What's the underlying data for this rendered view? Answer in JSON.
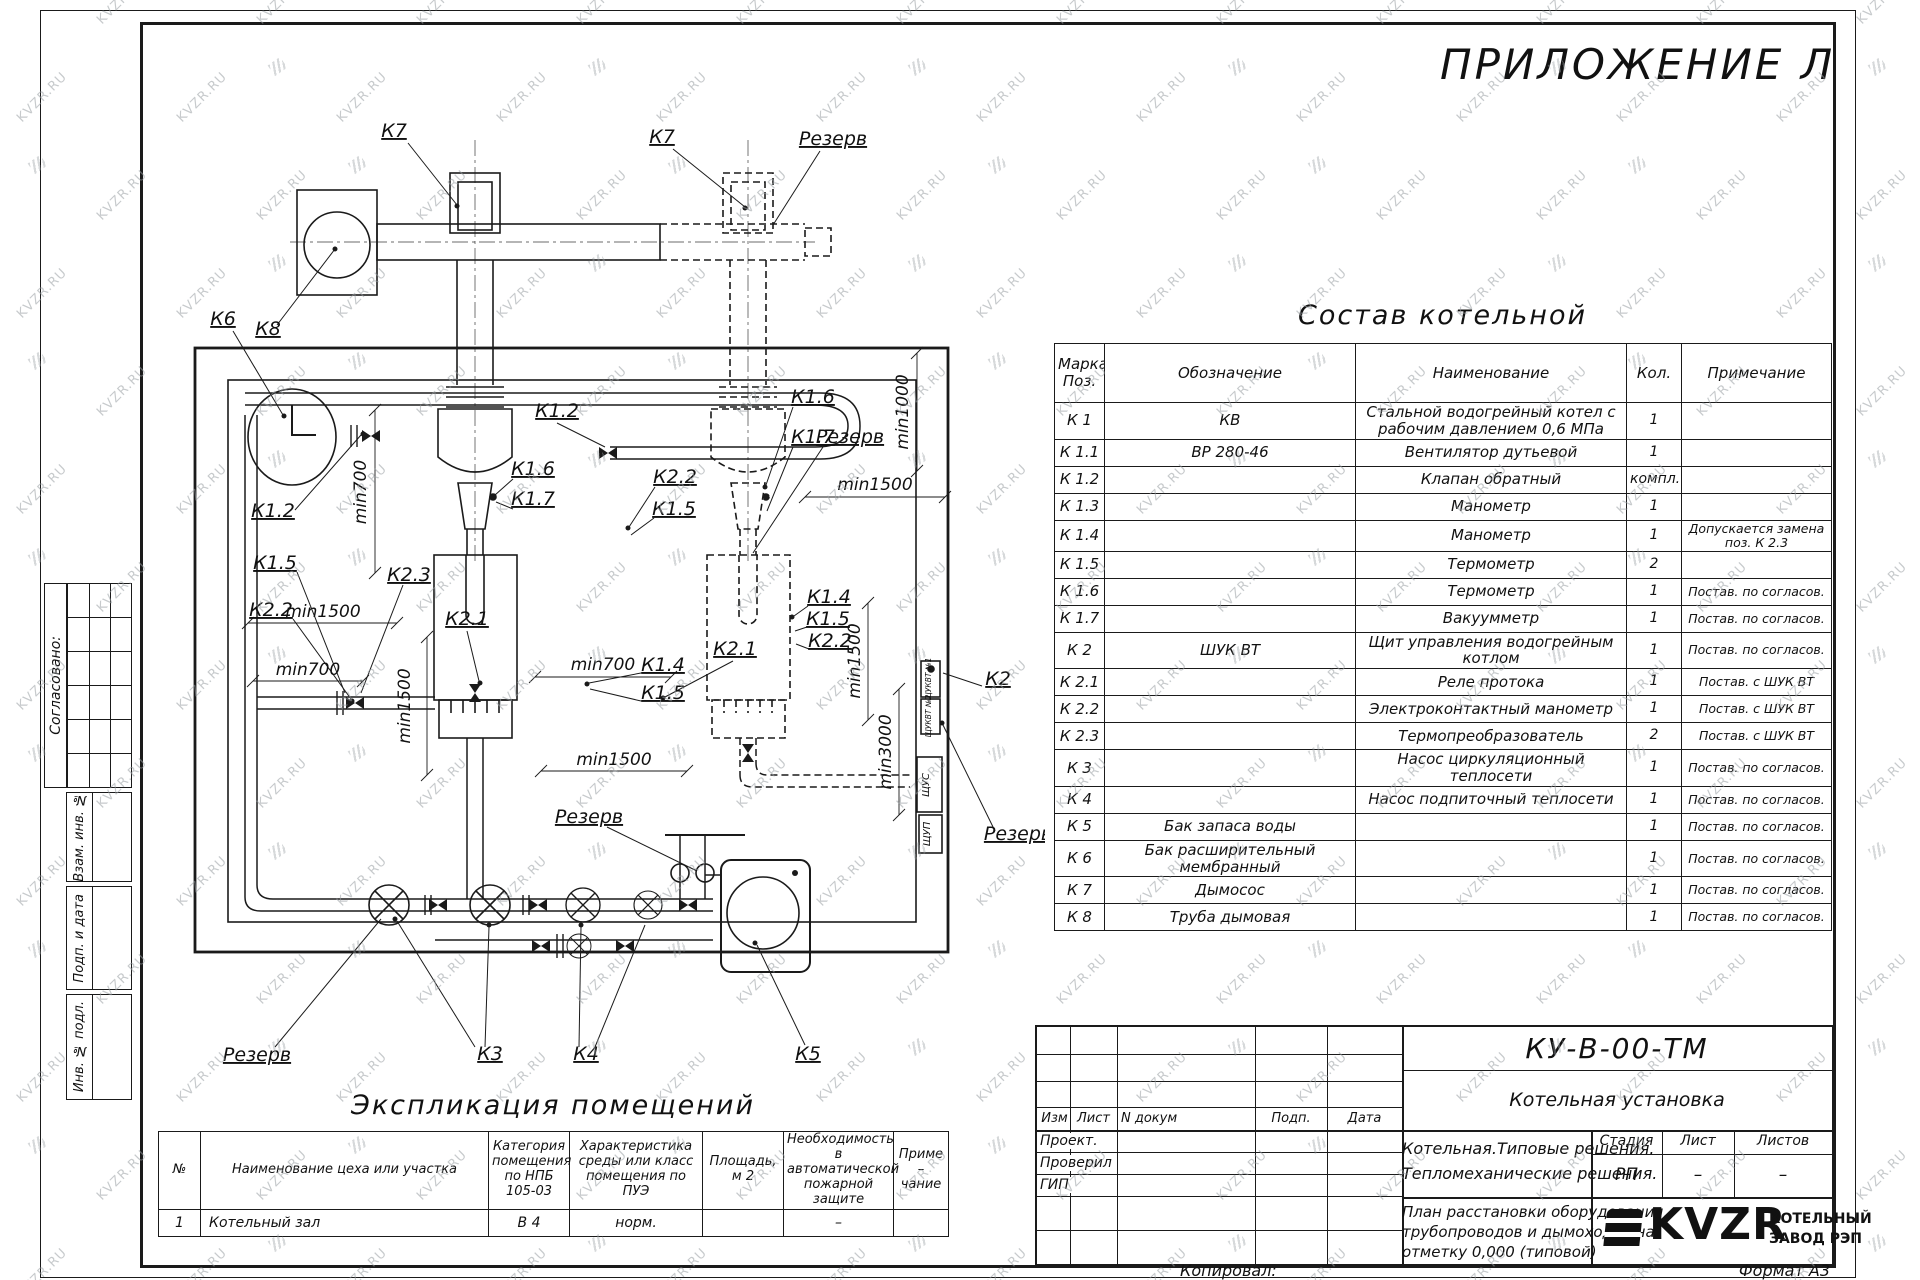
{
  "watermark": {
    "text": "KVZR.RU"
  },
  "page": {
    "appendix": "ПРИЛОЖЕНИЕ Л",
    "copied": "Копировал:",
    "format": "Формат А3"
  },
  "sidebar": {
    "agreed": "Согласовано:",
    "stamps": [
      "Взам. инв. №",
      "Подп. и дата",
      "Инв. № подл."
    ]
  },
  "composition": {
    "title": "Состав котельной",
    "headers": [
      "Марка Поз.",
      "Обозначение",
      "Наименование",
      "Кол.",
      "Примечание"
    ],
    "rows": [
      {
        "pos": "К 1",
        "sign": "КВ",
        "name": "Стальной водогрейный котел с рабочим давлением  0,6  МПа",
        "qty": "1",
        "note": ""
      },
      {
        "pos": "К 1.1",
        "sign": "ВР 280-46",
        "name": "Вентилятор дутьевой",
        "qty": "1",
        "note": ""
      },
      {
        "pos": "К 1.2",
        "sign": "",
        "name": "Клапан обратный",
        "qty": "компл.",
        "note": ""
      },
      {
        "pos": "К 1.3",
        "sign": "",
        "name": "Манометр",
        "qty": "1",
        "note": ""
      },
      {
        "pos": "К 1.4",
        "sign": "",
        "name": "Манометр",
        "qty": "1",
        "note": "Допускается замена поз. К 2.3"
      },
      {
        "pos": "К 1.5",
        "sign": "",
        "name": "Термометр",
        "qty": "2",
        "note": ""
      },
      {
        "pos": "К 1.6",
        "sign": "",
        "name": "Термометр",
        "qty": "1",
        "note": "Постав. по согласов."
      },
      {
        "pos": "К 1.7",
        "sign": "",
        "name": "Вакуумметр",
        "qty": "1",
        "note": "Постав. по согласов."
      },
      {
        "pos": "К 2",
        "sign": "ШУК ВТ",
        "name": "Щит управления водогрейным котлом",
        "qty": "1",
        "note": "Постав. по согласов."
      },
      {
        "pos": "К 2.1",
        "sign": "",
        "name": "Реле протока",
        "qty": "1",
        "note": "Постав. с ШУК ВТ"
      },
      {
        "pos": "К 2.2",
        "sign": "",
        "name": "Электроконтактный манометр",
        "qty": "1",
        "note": "Постав. с ШУК ВТ"
      },
      {
        "pos": "К 2.3",
        "sign": "",
        "name": "Термопреобразователь",
        "qty": "2",
        "note": "Постав. с ШУК ВТ"
      },
      {
        "pos": "К 3",
        "sign": "",
        "name": "Насос циркуляционный теплосети",
        "qty": "1",
        "note": "Постав. по согласов."
      },
      {
        "pos": "К 4",
        "sign": "",
        "name": "Насос подпиточный теплосети",
        "qty": "1",
        "note": "Постав. по согласов."
      },
      {
        "pos": "К 5",
        "sign": "Бак запаса воды",
        "name": "",
        "qty": "1",
        "note": "Постав. по согласов."
      },
      {
        "pos": "К 6",
        "sign": "Бак расширительный мембранный",
        "name": "",
        "qty": "1",
        "note": "Постав. по согласов."
      },
      {
        "pos": "К 7",
        "sign": "Дымосос",
        "name": "",
        "qty": "1",
        "note": "Постав. по согласов."
      },
      {
        "pos": "К 8",
        "sign": "Труба дымовая",
        "name": "",
        "qty": "1",
        "note": "Постав. по согласов."
      }
    ]
  },
  "explication": {
    "title": "Экспликация помещений",
    "headers": [
      "№",
      "Наименование цеха или участка",
      "Категория помещения по НПБ 105-03",
      "Характеристика среды или класс помещения по ПУЭ",
      "Площадь, м 2",
      "Необходимость в автоматической пожарной защите",
      "Приме – чание"
    ],
    "rows": [
      [
        "1",
        "Котельный зал",
        "В 4",
        "норм.",
        "",
        "–",
        ""
      ]
    ]
  },
  "titleblock": {
    "doc": "КУ-В-00-ТМ",
    "object": "Котельная установка",
    "cols": [
      "Изм",
      "Лист",
      "N докум",
      "Подп.",
      "Дата"
    ],
    "roles": [
      "Проект.",
      "Проверил",
      "ГИП"
    ],
    "desc1": "Котельная.Типовые решения.",
    "desc2": "Тепломеханические решения.",
    "stage_h": [
      "Стадия",
      "Лист",
      "Листов"
    ],
    "stage_v": [
      "РП",
      "–",
      "–"
    ],
    "sheet1": "План расстановки оборудования,",
    "sheet2": "трубопроводов и дымоходов на",
    "sheet3": "отметку  0,000  (типовой)",
    "brand": "KVZR",
    "brand_line1": "КОТЕЛЬНЫЙ",
    "brand_line2": "ЗАВОД РЭП"
  },
  "plan": {
    "labels": [
      {
        "t": "К7",
        "x": 289,
        "y": 52,
        "s": "k"
      },
      {
        "t": "К7",
        "x": 557,
        "y": 58,
        "s": "k"
      },
      {
        "t": "Резерв",
        "x": 728,
        "y": 60,
        "s": "r"
      },
      {
        "t": "К8",
        "x": 163,
        "y": 250,
        "s": "k"
      },
      {
        "t": "К6",
        "x": 118,
        "y": 240,
        "s": "k"
      },
      {
        "t": "К1.2",
        "x": 452,
        "y": 332,
        "s": "k"
      },
      {
        "t": "К1.6",
        "x": 428,
        "y": 390,
        "s": "k"
      },
      {
        "t": "К1.7",
        "x": 428,
        "y": 420,
        "s": "k"
      },
      {
        "t": "К1.6",
        "x": 708,
        "y": 318,
        "s": "k"
      },
      {
        "t": "К1.7",
        "x": 708,
        "y": 358,
        "s": "k"
      },
      {
        "t": "К2.2",
        "x": 570,
        "y": 398,
        "s": "k"
      },
      {
        "t": "К1.5",
        "x": 569,
        "y": 430,
        "s": "k"
      },
      {
        "t": "Резерв",
        "x": 745,
        "y": 358,
        "s": "r"
      },
      {
        "t": "min1000",
        "x": 803,
        "y": 327,
        "s": "d",
        "r": -90
      },
      {
        "t": "min1500",
        "x": 770,
        "y": 405,
        "s": "d"
      },
      {
        "t": "К1.2",
        "x": 168,
        "y": 432,
        "s": "k"
      },
      {
        "t": "К1.5",
        "x": 170,
        "y": 484,
        "s": "k"
      },
      {
        "t": "К2.2",
        "x": 166,
        "y": 531,
        "s": "k"
      },
      {
        "t": "К2.3",
        "x": 304,
        "y": 496,
        "s": "k"
      },
      {
        "t": "min700",
        "x": 261,
        "y": 407,
        "s": "d",
        "r": -90
      },
      {
        "t": "min700",
        "x": 203,
        "y": 590,
        "s": "d"
      },
      {
        "t": "min1500",
        "x": 218,
        "y": 532,
        "s": "d"
      },
      {
        "t": "К1.4",
        "x": 558,
        "y": 586,
        "s": "k"
      },
      {
        "t": "К1.5",
        "x": 558,
        "y": 614,
        "s": "k"
      },
      {
        "t": "К2.1",
        "x": 362,
        "y": 540,
        "s": "k"
      },
      {
        "t": "min1500",
        "x": 305,
        "y": 621,
        "s": "d",
        "r": -90
      },
      {
        "t": "min700",
        "x": 498,
        "y": 585,
        "s": "d"
      },
      {
        "t": "min1500",
        "x": 509,
        "y": 680,
        "s": "d"
      },
      {
        "t": "К2.1",
        "x": 630,
        "y": 570,
        "s": "k"
      },
      {
        "t": "К1.4",
        "x": 724,
        "y": 518,
        "s": "k"
      },
      {
        "t": "К1.5",
        "x": 723,
        "y": 540,
        "s": "k"
      },
      {
        "t": "К2.2",
        "x": 725,
        "y": 562,
        "s": "k"
      },
      {
        "t": "min1500",
        "x": 755,
        "y": 576,
        "s": "d",
        "r": -90
      },
      {
        "t": "min3000",
        "x": 786,
        "y": 667,
        "s": "d",
        "r": -90
      },
      {
        "t": "К2",
        "x": 893,
        "y": 600,
        "s": "k"
      },
      {
        "t": "Резерв",
        "x": 913,
        "y": 755,
        "s": "r"
      },
      {
        "t": "Резерв",
        "x": 484,
        "y": 738,
        "s": "r"
      },
      {
        "t": "Резерв",
        "x": 152,
        "y": 976,
        "s": "r"
      },
      {
        "t": "К3",
        "x": 385,
        "y": 975,
        "s": "k"
      },
      {
        "t": "К4",
        "x": 481,
        "y": 975,
        "s": "k"
      },
      {
        "t": "К5",
        "x": 703,
        "y": 975,
        "s": "k"
      },
      {
        "t": "ЩУКВТ №1",
        "x": 826,
        "y": 594,
        "s": "c",
        "r": -90
      },
      {
        "t": "ЩУКВТ №2",
        "x": 826,
        "y": 631,
        "s": "c",
        "r": -90
      },
      {
        "t": "ЩУС",
        "x": 824,
        "y": 700,
        "s": "c2",
        "r": -90
      },
      {
        "t": "ЩУП",
        "x": 825,
        "y": 749,
        "s": "c2",
        "r": -90
      }
    ],
    "dims": [
      {
        "x1": 270,
        "y1": 325,
        "x2": 270,
        "y2": 488
      },
      {
        "x1": 322,
        "y1": 552,
        "x2": 322,
        "y2": 690
      },
      {
        "x1": 812,
        "y1": 268,
        "x2": 812,
        "y2": 386
      },
      {
        "x1": 763,
        "y1": 518,
        "x2": 763,
        "y2": 635
      },
      {
        "x1": 794,
        "y1": 604,
        "x2": 794,
        "y2": 730
      },
      {
        "x1": 148,
        "y1": 596,
        "x2": 258,
        "y2": 596
      },
      {
        "x1": 143,
        "y1": 538,
        "x2": 292,
        "y2": 538
      },
      {
        "x1": 430,
        "y1": 592,
        "x2": 566,
        "y2": 592
      },
      {
        "x1": 436,
        "y1": 686,
        "x2": 582,
        "y2": 686
      },
      {
        "x1": 700,
        "y1": 412,
        "x2": 840,
        "y2": 412
      }
    ]
  }
}
